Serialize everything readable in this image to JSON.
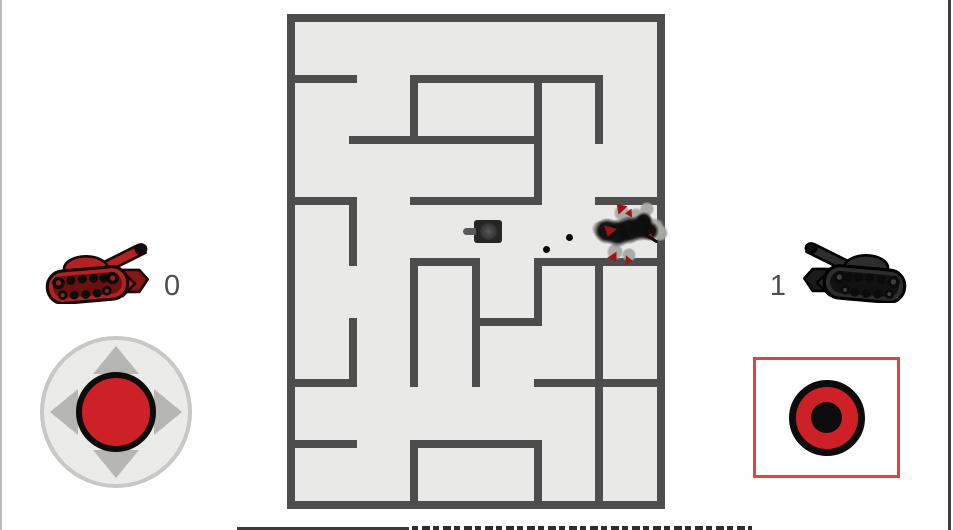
{
  "scoreboard": {
    "players": [
      {
        "side": "left",
        "name": "red-player",
        "score": "0",
        "palette": {
          "main": "#b32121",
          "dark": "#871616",
          "tread": "#6b0f0f",
          "hub": "#9e1a1a",
          "outline": "#190707"
        },
        "mirrored": false
      },
      {
        "side": "right",
        "name": "black-player",
        "score": "1",
        "palette": {
          "main": "#2d2d2d",
          "dark": "#1a1a1a",
          "tread": "#121212",
          "hub": "#404040",
          "outline": "#000000"
        },
        "mirrored": true
      }
    ]
  },
  "colors": {
    "page_bg": "#ffffff",
    "maze_bg": "#e9e9e7",
    "wall": "#4d4d4d",
    "knob_red": "#ce2027",
    "fire_border": "#e8403a",
    "joystick_base": "#ebebe9",
    "joystick_ring": "#c8c8c6",
    "arrow_gray": "#b5b5b3",
    "score_text": "#4c4c4c"
  },
  "maze": {
    "left": 287,
    "top": 14,
    "width": 378,
    "height": 495,
    "cols": 6,
    "rows": 8,
    "wall_thickness": 8,
    "walls": {
      "horizontal": [
        [
          0,
          0,
          6
        ],
        [
          1,
          0,
          1
        ],
        [
          1,
          2,
          5
        ],
        [
          2,
          1,
          4
        ],
        [
          3,
          0,
          1
        ],
        [
          3,
          2,
          4
        ],
        [
          3,
          5,
          6
        ],
        [
          4,
          2,
          3
        ],
        [
          4,
          4,
          6
        ],
        [
          5,
          3,
          4
        ],
        [
          6,
          0,
          1
        ],
        [
          6,
          4,
          6
        ],
        [
          7,
          0,
          1
        ],
        [
          7,
          2,
          4
        ],
        [
          8,
          0,
          6
        ]
      ],
      "vertical": [
        [
          0,
          0,
          8
        ],
        [
          6,
          0,
          8
        ],
        [
          2,
          1,
          2
        ],
        [
          4,
          1,
          3
        ],
        [
          5,
          1,
          2
        ],
        [
          1,
          3,
          4
        ],
        [
          2,
          4,
          6
        ],
        [
          3,
          4,
          6
        ],
        [
          4,
          4,
          5
        ],
        [
          5,
          4,
          8
        ],
        [
          1,
          5,
          6
        ],
        [
          2,
          7,
          8
        ],
        [
          4,
          7,
          8
        ]
      ]
    }
  },
  "entities": {
    "black_tank": {
      "x": 474,
      "y": 220,
      "width": 28,
      "height": 23,
      "facing": "left"
    },
    "bullets": [
      {
        "x": 546,
        "y": 249,
        "r": 3.5
      },
      {
        "x": 569,
        "y": 237,
        "r": 3.5
      }
    ],
    "explosion": {
      "cx": 628,
      "cy": 231,
      "puffs": [
        {
          "x": 622,
          "y": 213,
          "r": 7
        },
        {
          "x": 636,
          "y": 218,
          "r": 8
        },
        {
          "x": 654,
          "y": 228,
          "r": 8
        },
        {
          "x": 660,
          "y": 233,
          "r": 7
        },
        {
          "x": 615,
          "y": 252,
          "r": 7
        },
        {
          "x": 629,
          "y": 255,
          "r": 6
        },
        {
          "x": 600,
          "y": 229,
          "r": 7
        },
        {
          "x": 647,
          "y": 209,
          "r": 6
        }
      ],
      "smoke": [
        {
          "x": 607,
          "y": 231,
          "r": 10
        },
        {
          "x": 618,
          "y": 233,
          "r": 11
        },
        {
          "x": 629,
          "y": 230,
          "r": 11
        },
        {
          "x": 640,
          "y": 228,
          "r": 10
        },
        {
          "x": 649,
          "y": 231,
          "r": 8
        },
        {
          "x": 644,
          "y": 221,
          "r": 7
        }
      ],
      "shards": [
        {
          "x": 620,
          "y": 209,
          "size": 11,
          "rot": 200
        },
        {
          "x": 630,
          "y": 214,
          "size": 8,
          "rot": 150
        },
        {
          "x": 611,
          "y": 230,
          "size": 12,
          "rot": 80
        },
        {
          "x": 614,
          "y": 256,
          "size": 10,
          "rot": 30
        },
        {
          "x": 627,
          "y": 259,
          "size": 9,
          "rot": -20
        },
        {
          "x": 651,
          "y": 237,
          "size": 7,
          "rot": 120
        }
      ],
      "fragment_line": {
        "x": 641,
        "y": 236,
        "length": 18,
        "rot": 32
      }
    }
  }
}
